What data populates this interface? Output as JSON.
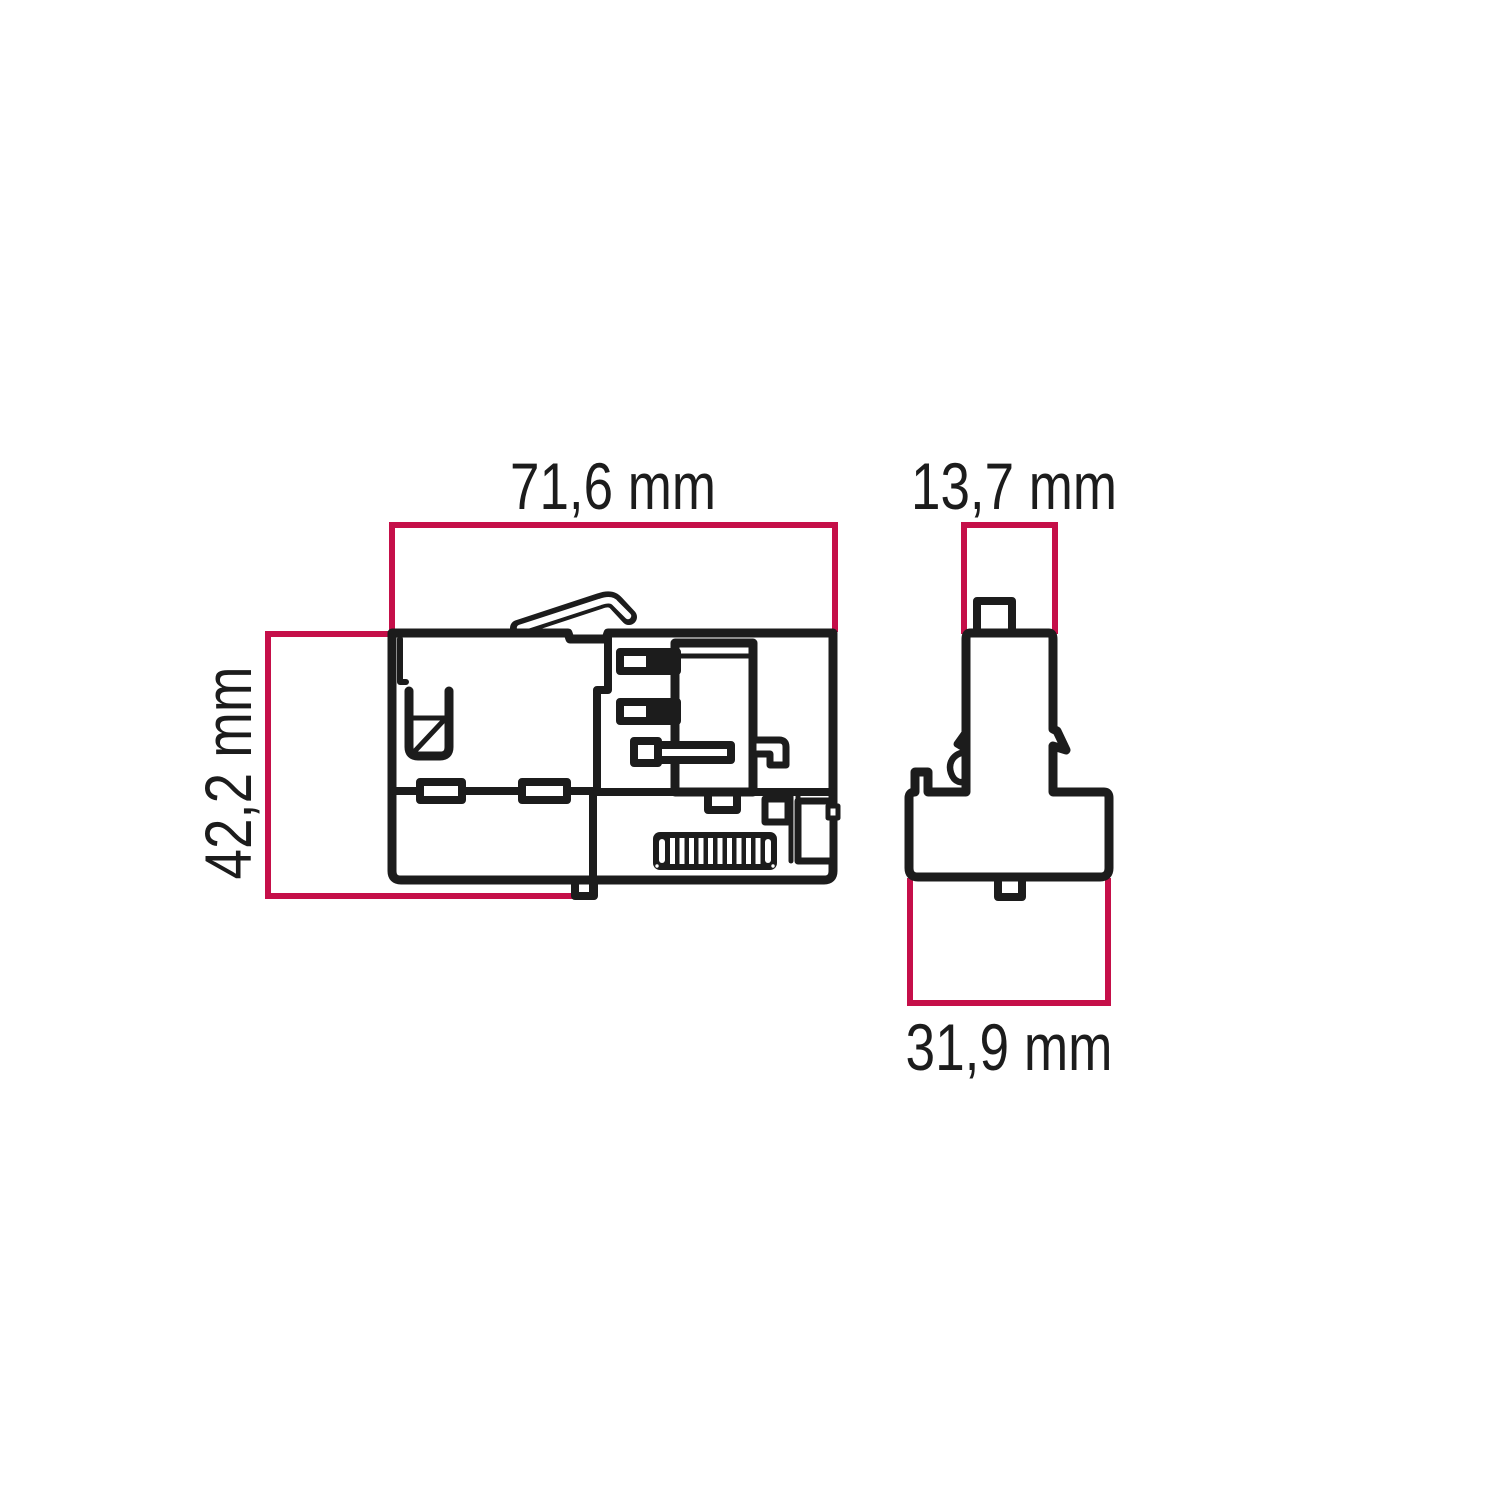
{
  "diagram": {
    "type": "technical dimension drawing",
    "subject": "track lighting adapter, side view and front profile view",
    "views": [
      {
        "id": "side-view",
        "description": "side elevation of adapter body with release lever, clip, contact block and ribbed grip",
        "dimensions": {
          "width_label": "71,6 mm",
          "height_label": "42,2 mm"
        }
      },
      {
        "id": "front-view",
        "description": "front profile of adapter: narrow stem with latch hooks on wider base",
        "dimensions": {
          "top_width_label": "13,7 mm",
          "base_width_label": "31,9 mm"
        }
      }
    ],
    "labels": {
      "width": "71,6 mm",
      "height": "42,2 mm",
      "top_width": "13,7 mm",
      "base_width": "31,9 mm"
    },
    "colors": {
      "outline": "#1c1c1c",
      "dimension_line": "#c50f49",
      "background": "#ffffff"
    }
  }
}
